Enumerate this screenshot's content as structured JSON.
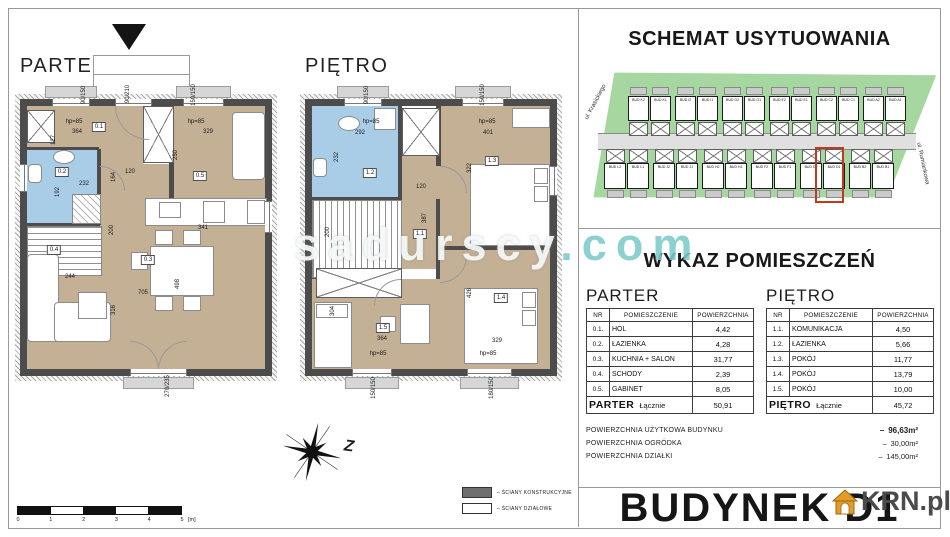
{
  "watermark": {
    "name": "sadurscy",
    "tld": ".com"
  },
  "compass": {
    "label": "Z"
  },
  "scalebar": {
    "ticks": [
      "0",
      "1",
      "2",
      "3",
      "4",
      "5"
    ],
    "unit": "[m]"
  },
  "legend": {
    "items": [
      {
        "swatch": "dark",
        "label": "ŚCIANY KONSTRUKCYJNE"
      },
      {
        "swatch": "light",
        "label": "ŚCIANY DZIAŁOWE"
      }
    ]
  },
  "site": {
    "title": "SCHEMAT USYTUOWANIA",
    "street_left": "ul. Krasickiego",
    "street_right": "ul. Rumiankowa",
    "row_top": [
      "BUD K2",
      "BUD K1",
      "BUD I2",
      "BUD I1",
      "BUD G2",
      "BUD G1",
      "BUD E2",
      "BUD E1",
      "BUD C2",
      "BUD C1",
      "BUD A2",
      "BUD A1"
    ],
    "row_bottom": [
      "BUD L2",
      "BUD L1",
      "BUD J2",
      "BUD J1",
      "BUD H2",
      "BUD H1",
      "BUD F2",
      "BUD F1",
      "BUD D2",
      "BUD D1",
      "BUD B2",
      "BUD B1"
    ],
    "highlight": "BUD D1"
  },
  "plans": {
    "parter": {
      "title": "PARTER",
      "labels": [
        {
          "t": "90/150",
          "x": 84,
          "y": 95,
          "r": -90
        },
        {
          "t": "90/210",
          "x": 128,
          "y": 94,
          "r": -90
        },
        {
          "t": "150/150",
          "x": 194,
          "y": 95,
          "r": -90
        },
        {
          "t": "hp=85",
          "x": 74,
          "y": 122
        },
        {
          "t": "364",
          "x": 77,
          "y": 132
        },
        {
          "t": "0.1",
          "x": 99,
          "y": 127,
          "box": true
        },
        {
          "t": "127",
          "x": 54,
          "y": 140,
          "r": -90
        },
        {
          "t": "hp=85",
          "x": 196,
          "y": 122
        },
        {
          "t": "329",
          "x": 208,
          "y": 132
        },
        {
          "t": "0.2",
          "x": 62,
          "y": 172,
          "box": true
        },
        {
          "t": "232",
          "x": 84,
          "y": 184
        },
        {
          "t": "164",
          "x": 114,
          "y": 177,
          "r": -90
        },
        {
          "t": "120",
          "x": 130,
          "y": 172
        },
        {
          "t": "192",
          "x": 58,
          "y": 192,
          "r": -90
        },
        {
          "t": "250",
          "x": 176,
          "y": 155,
          "r": -90
        },
        {
          "t": "0.5",
          "x": 200,
          "y": 176,
          "box": true
        },
        {
          "t": "0.4",
          "x": 54,
          "y": 250,
          "box": true
        },
        {
          "t": "244",
          "x": 70,
          "y": 277
        },
        {
          "t": "705",
          "x": 143,
          "y": 293
        },
        {
          "t": "316",
          "x": 114,
          "y": 310,
          "r": -90
        },
        {
          "t": "0.3",
          "x": 148,
          "y": 260,
          "box": true
        },
        {
          "t": "341",
          "x": 203,
          "y": 228
        },
        {
          "t": "498",
          "x": 178,
          "y": 284,
          "r": -90
        },
        {
          "t": "200",
          "x": 112,
          "y": 230,
          "r": -90
        },
        {
          "t": "270/235",
          "x": 168,
          "y": 386,
          "r": -90
        }
      ]
    },
    "pietro": {
      "title": "PIĘTRO",
      "labels": [
        {
          "t": "90/150",
          "x": 367,
          "y": 95,
          "r": -90
        },
        {
          "t": "150/150",
          "x": 483,
          "y": 95,
          "r": -90
        },
        {
          "t": "hp=85",
          "x": 371,
          "y": 122
        },
        {
          "t": "292",
          "x": 360,
          "y": 133
        },
        {
          "t": "232",
          "x": 337,
          "y": 157,
          "r": -90
        },
        {
          "t": "hp=85",
          "x": 487,
          "y": 122
        },
        {
          "t": "401",
          "x": 488,
          "y": 133
        },
        {
          "t": "1.2",
          "x": 370,
          "y": 173,
          "box": true
        },
        {
          "t": "1.3",
          "x": 492,
          "y": 161,
          "box": true
        },
        {
          "t": "322",
          "x": 470,
          "y": 168,
          "r": -90
        },
        {
          "t": "120",
          "x": 421,
          "y": 187
        },
        {
          "t": "387",
          "x": 425,
          "y": 218,
          "r": -90
        },
        {
          "t": "200",
          "x": 328,
          "y": 232,
          "r": -90
        },
        {
          "t": "1.1",
          "x": 420,
          "y": 234,
          "box": true
        },
        {
          "t": "426",
          "x": 470,
          "y": 293,
          "r": -90
        },
        {
          "t": "1.4",
          "x": 501,
          "y": 298,
          "box": true
        },
        {
          "t": "304",
          "x": 333,
          "y": 311,
          "r": -90
        },
        {
          "t": "1.5",
          "x": 383,
          "y": 328,
          "box": true
        },
        {
          "t": "364",
          "x": 382,
          "y": 339
        },
        {
          "t": "329",
          "x": 497,
          "y": 341
        },
        {
          "t": "hp=85",
          "x": 378,
          "y": 354
        },
        {
          "t": "hp=85",
          "x": 488,
          "y": 354
        },
        {
          "t": "150/150",
          "x": 374,
          "y": 388,
          "r": -90
        },
        {
          "t": "180/150",
          "x": 492,
          "y": 388,
          "r": -90
        }
      ]
    }
  },
  "wykaz": {
    "title": "WYKAZ POMIESZCZEŃ",
    "dash": "–",
    "parter": {
      "heading": "PARTER",
      "headers": [
        "NR",
        "POMIESZCZENIE",
        "POWIERZCHNIA"
      ],
      "rows": [
        [
          "0.1.",
          "HOL",
          "4,42"
        ],
        [
          "0.2.",
          "ŁAZIENKA",
          "4,28"
        ],
        [
          "0.3.",
          "KUCHNIA + SALON",
          "31,77"
        ],
        [
          "0.4.",
          "SCHODY",
          "2,39"
        ],
        [
          "0.5.",
          "GABINET",
          "8,05"
        ]
      ],
      "total": {
        "label": "PARTER",
        "suffix": "Łącznie",
        "value": "50,91"
      }
    },
    "pietro": {
      "heading": "PIĘTRO",
      "headers": [
        "NR",
        "POMIESZCZENIE",
        "POWIERZCHNIA"
      ],
      "rows": [
        [
          "1.1.",
          "KOMUNIKACJA",
          "4,50"
        ],
        [
          "1.2.",
          "ŁAZIENKA",
          "5,66"
        ],
        [
          "1.3.",
          "POKÓJ",
          "11,77"
        ],
        [
          "1.4.",
          "POKÓJ",
          "13,79"
        ],
        [
          "1.5.",
          "POKÓJ",
          "10,00"
        ]
      ],
      "total": {
        "label": "PIĘTRO",
        "suffix": "Łącznie",
        "value": "45,72"
      }
    },
    "summary": [
      {
        "label": "POWIERZCHNIA UŻYTKOWA BUDYNKU",
        "value": "96,63m²"
      },
      {
        "label": "POWIERZCHNIA OGRÓDKA",
        "value": "30,00m²"
      },
      {
        "label": "POWIERZCHNIA DZIAŁKI",
        "value": "145,00m²"
      }
    ]
  },
  "building": {
    "title": "BUDYNEK D1"
  },
  "logo": {
    "text": "KRN.pl"
  },
  "colors": {
    "room_tan": "#c4b095",
    "room_blue": "#a9cde6",
    "wall": "#4c4c4c",
    "site_green": "#a6d7a0",
    "highlight_red": "#c23a1e",
    "watermark_teal": "#7ccaca",
    "logo_orange": "#e59b28"
  }
}
